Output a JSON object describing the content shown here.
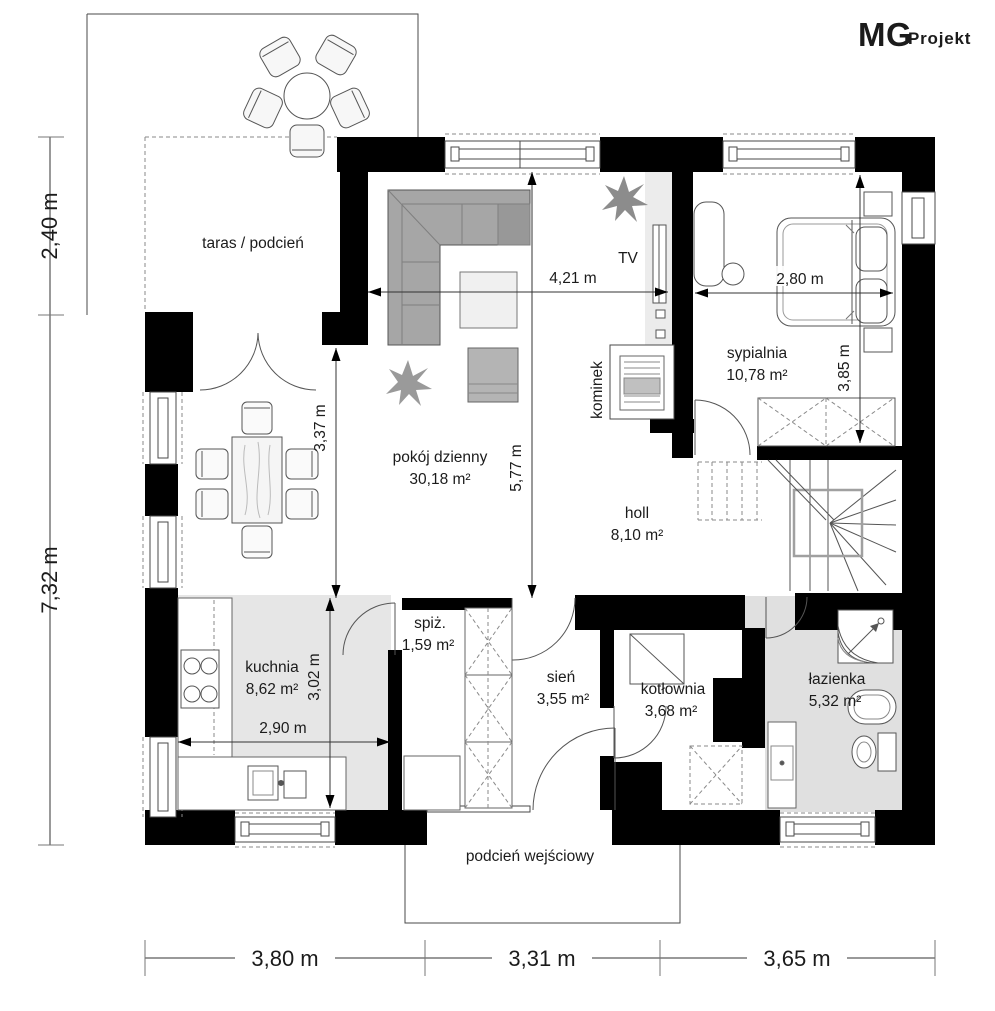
{
  "logo": {
    "mg": "MG",
    "projekt": "Projekt"
  },
  "rooms": {
    "taras": {
      "name": "taras / podcień"
    },
    "living": {
      "name": "pokój dzienny",
      "area": "30,18 m²"
    },
    "bedroom": {
      "name": "sypialnia",
      "area": "10,78 m²"
    },
    "hall": {
      "name": "holl",
      "area": "8,10 m²"
    },
    "kitchen": {
      "name": "kuchnia",
      "area": "8,62 m²"
    },
    "pantry": {
      "name": "spiż.",
      "area": "1,59 m²"
    },
    "vestibule": {
      "name": "sień",
      "area": "3,55 m²"
    },
    "boiler": {
      "name": "kotłownia",
      "area": "3,68 m²"
    },
    "bath": {
      "name": "łazienka",
      "area": "5,32 m²"
    },
    "porch": {
      "name": "podcień wejściowy"
    }
  },
  "fixtures": {
    "tv": "TV",
    "fireplace": "kominek"
  },
  "dims": {
    "d240": "2,40 m",
    "d732": "7,32 m",
    "d380": "3,80 m",
    "d331": "3,31 m",
    "d365": "3,65 m",
    "d421": "4,21 m",
    "d280": "2,80 m",
    "d337": "3,37 m",
    "d577": "5,77 m",
    "d385": "3,85 m",
    "d302": "3,02 m",
    "d290": "2,90 m"
  },
  "colors": {
    "wall": "#000000",
    "floor_gray": "#e4e4e4",
    "sofa_gray": "#a6a6a6",
    "line": "#4a4a4a"
  }
}
